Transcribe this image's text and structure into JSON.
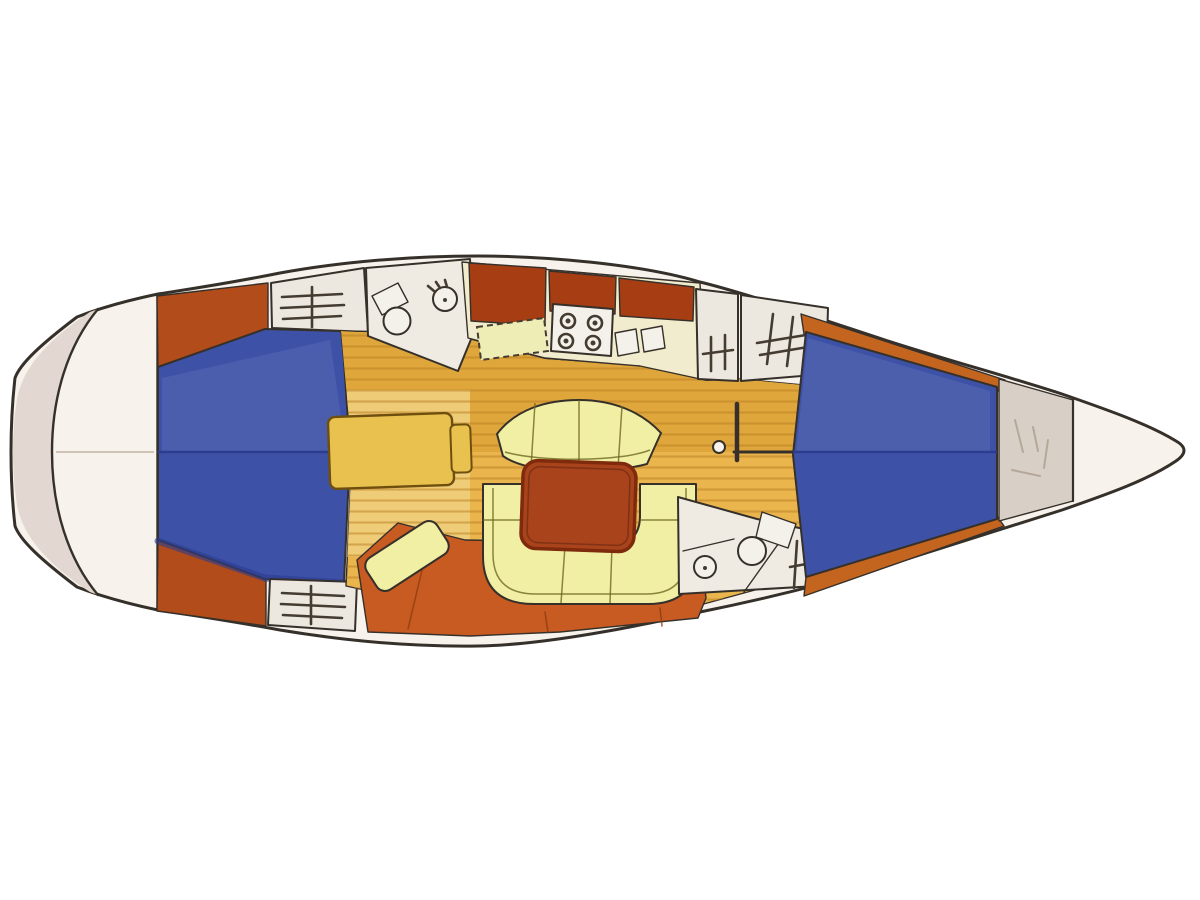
{
  "diagram": {
    "kind": "sailing-yacht-interior-floor-plan",
    "orientation": {
      "bow": "right",
      "stern": "left"
    },
    "canvas": {
      "width": 1200,
      "height": 900
    },
    "palette": {
      "background": "#ffffff",
      "hull_line": "#36302a",
      "deck_white": "#f7f3ec",
      "stern_shade": "#e2d8d1",
      "berth_blue": "#3d52a7",
      "berth_blue_dark": "#2c3c8f",
      "berth_sheen": "#5a6cbd",
      "wedge_orange": "#b24c1a",
      "cabinet_red": "#a63d13",
      "v_trim": "#c4651f",
      "terracotta": "#c75b22",
      "floor_gold": "#e9b54c",
      "floor_gold_dark": "#dfa63c",
      "floor_pale": "#efcf7d",
      "floor_stripe": "#b97d22",
      "counter_cream": "#f2ecce",
      "icebox_cream": "#efedb6",
      "seat_cream": "#f1efa4",
      "table_red": "#a8431c",
      "table_red_dark": "#7e2a0c",
      "nav_yellow": "#e9c14e",
      "head_white": "#efeae2",
      "locker_white": "#ece7df",
      "fixture_white": "#f4f0ea",
      "anchor_grey": "#d8cfc6"
    },
    "features": {
      "stove_burners": 4,
      "galley_sinks": 2,
      "cabins_shown": 2
    },
    "regions": {
      "hull": "Hull outline",
      "swim_platform": "Stern swim platform / transom",
      "aft_cabin": "Aft double berth cabin",
      "aft_locker_top": "Aft hanging locker (port)",
      "aft_locker_bottom": "Aft hanging locker (starboard)",
      "aft_head": "Aft heads - WC and basin",
      "galley": "Galley counter",
      "stove": "Four-burner stove",
      "double_sink": "Twin galley sinks",
      "icebox": "Worktop / icebox lid",
      "companionway": "Companionway steps",
      "hanging_locker_fwd": "Hanging locker",
      "saloon_floor": "Saloon sole (wood planking)",
      "curved_settee": "Curved saloon settee",
      "u_settee": "U-shaped settee",
      "saloon_table": "Saloon table",
      "nav_table": "Chart table",
      "nav_seat": "Navigator seat",
      "mast": "Mast and compression post",
      "forward_head": "Forward heads - WC and basin",
      "head_locker": "Heads hanging locker",
      "v_berth": "Forward V-berth cabin",
      "anchor_locker": "Anchor locker",
      "bow": "Bow"
    }
  }
}
